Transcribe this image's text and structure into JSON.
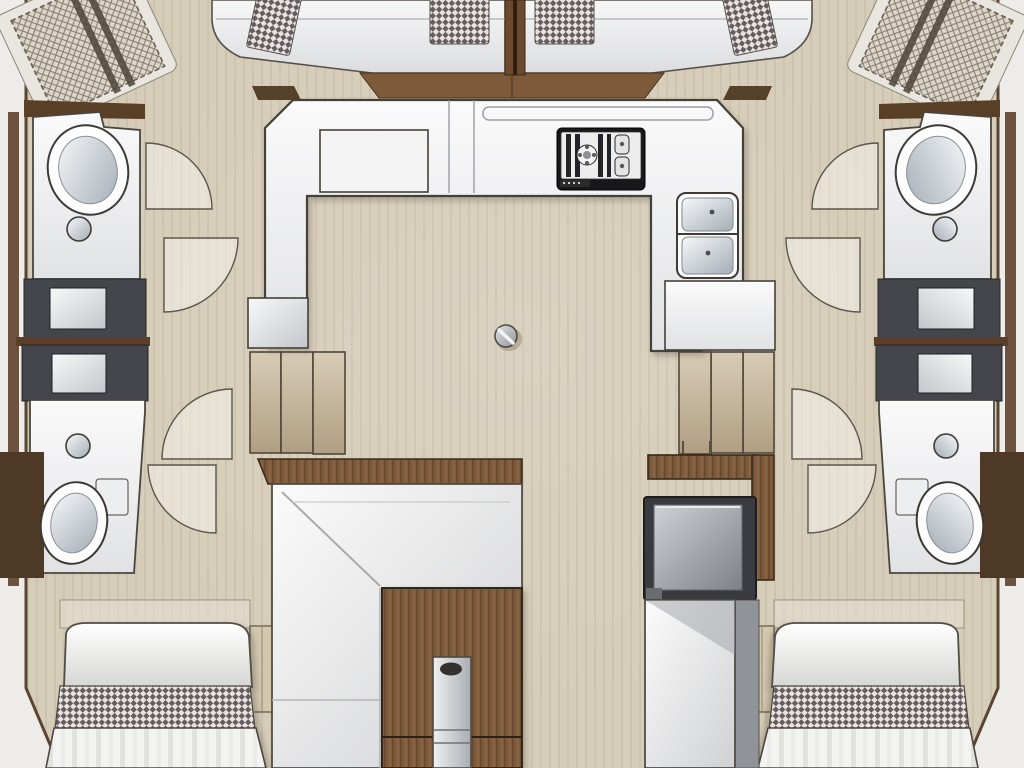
{
  "floorplan": {
    "type": "catamaran-yacht-interior-layout",
    "description": "Top-down floor plan of a sailing catamaran: forward trampolines and cockpit bench, central saloon with U-shaped galley, salon table and nav seat, symmetric port and starboard hulls each with washbasin vanity, head with toilet, companionway steps and aft berth",
    "areas": {
      "forward": [
        "port bow trampoline net",
        "forward cockpit bench with checkered cushions",
        "starboard bow trampoline net"
      ],
      "main_deck": [
        "U-shaped galley counter",
        "cooktop",
        "double sink",
        "mast compression post",
        "L-shaped salon settee",
        "salon table with pedestal",
        "chart table with forward-facing seat"
      ],
      "port_hull": [
        "washbasin vanity",
        "storage hatch panels",
        "companionway steps",
        "head with toilet",
        "aft island berth"
      ],
      "starboard_hull": [
        "washbasin vanity",
        "storage hatch panels",
        "companionway steps",
        "head with toilet",
        "aft island berth"
      ]
    },
    "palette": {
      "floor_beige": "#d6cdb9",
      "counter_white": "#f2f2f4",
      "wood_brown": "#7b5a3b",
      "dark_wood": "#4e3926",
      "dark_panel": "#43454a",
      "step_tan": "#c9bba1",
      "check_dark": "#655e60",
      "check_light": "#eae2e1",
      "metal_gray": "#b9bdc1",
      "outline": "#4a463f"
    }
  }
}
